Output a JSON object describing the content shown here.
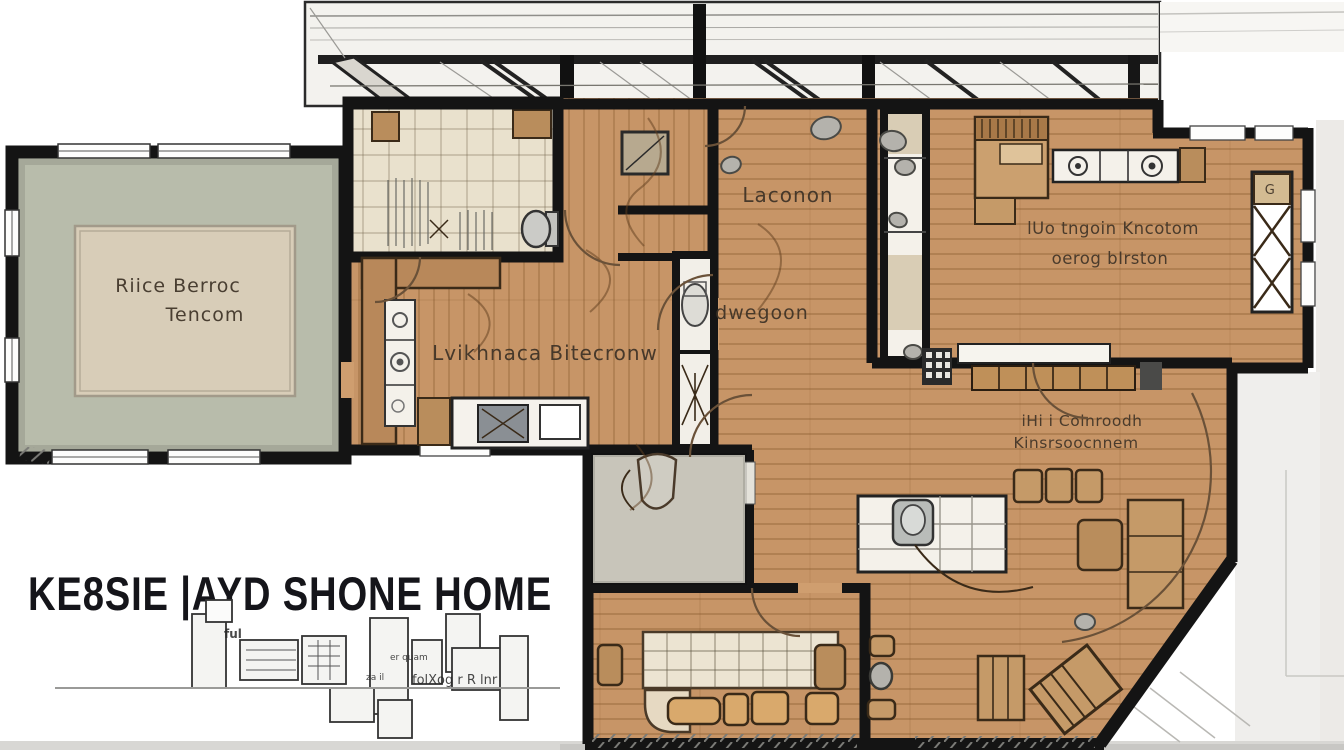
{
  "title": {
    "text": "KE8SIE |AYD SHONE HOME"
  },
  "rooms": {
    "storage": {
      "line1": "Riice Berroc",
      "line2": "Tencom"
    },
    "kitchen_living": {
      "label": "Lvikhnaca Bitecronw"
    },
    "hall": {
      "label": "Laconon"
    },
    "middle": {
      "label": "dwegoon"
    },
    "bedroom": {
      "line1": "lUo tngoin Kncotom",
      "line2": "oerog bIrston"
    },
    "family": {
      "line1": "iHi i Colnroodh",
      "line2": "Kinsrsoocnnem"
    },
    "shelf_mark": "G"
  },
  "annotations": {
    "note1": "ful",
    "note2": "er quam",
    "note3": "za il",
    "note4": "folXog r R lnr"
  },
  "palette": {
    "wall": "#141414",
    "wood": "#c79567",
    "tile": "#e9e1cd",
    "storage_floor": "#b8bcab",
    "rug": "#d8cdb8",
    "patio": "#c8c5ba",
    "counter_white": "#f4f1ea",
    "furniture_tan": "#d2a36c",
    "label_ink": "#3d3226"
  }
}
